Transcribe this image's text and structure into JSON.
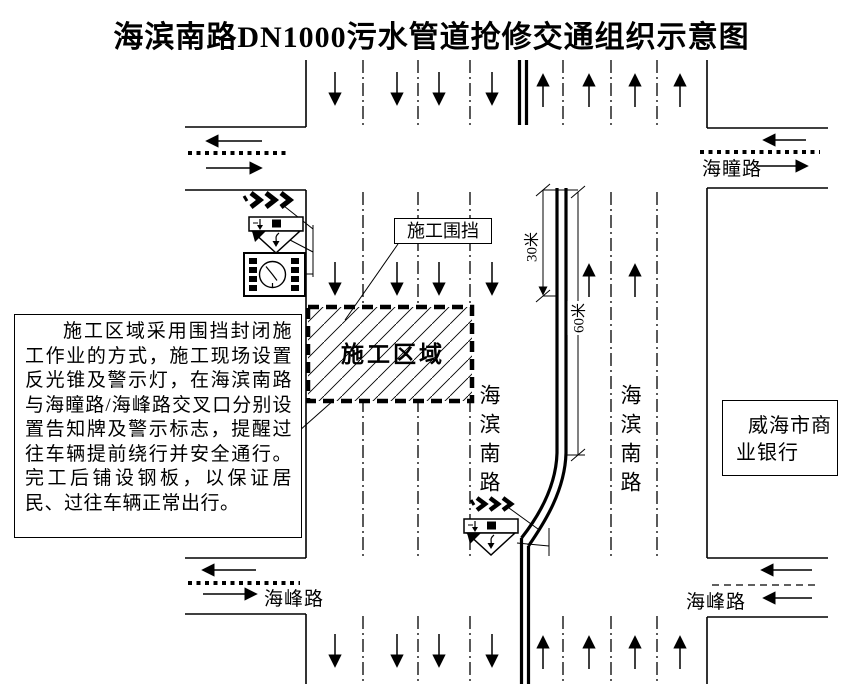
{
  "title": "海滨南路DN1000污水管道抢修交通组织示意图",
  "note": {
    "text": "施工区域采用围挡封闭施工作业的方式，施工现场设置反光锥及警示灯，在海滨南路与海瞳路/海峰路交叉口分别设置告知牌及警示标志，提醒过往车辆提前绕行并安全通行。完工后铺设钢板，以保证居民、过往车辆正常出行。"
  },
  "labels": {
    "construction_zone": "施工区域",
    "construction_fence": "施工围挡",
    "bank": "威海市商业银行",
    "main_road": "海滨南路",
    "top_street": "海瞳路",
    "bottom_street": "海峰路",
    "dim_30m": "30米",
    "dim_60m": "60米"
  },
  "icons": {
    "chevrons": "triple-right-chevron-marks",
    "warning_sign": "inverted-triangle-detour-warning-sign",
    "light_board": "warning-light-board-with-clock"
  },
  "colors": {
    "ink": "#000000",
    "paper": "#ffffff"
  }
}
